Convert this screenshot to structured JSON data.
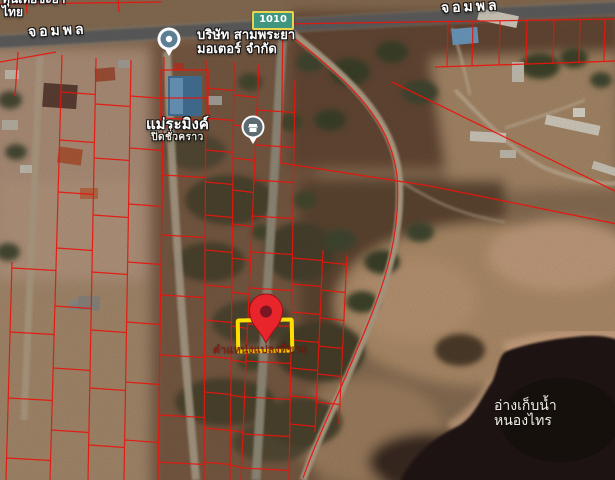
{
  "map": {
    "imagery": "satellite",
    "road_labels": {
      "left": "จอมพล",
      "right": "จอมพล"
    },
    "route_badge": {
      "number": "1010",
      "bg": "#3e9681",
      "border": "#e9d44e"
    },
    "pois": {
      "top_left_partial": {
        "line1": "ทุนเทียชะยา",
        "line2": "ไทย"
      },
      "motor_company": {
        "line1": "บริษัท สามพระยา",
        "line2": "มอเตอร์ จำกัด"
      },
      "closed_place": {
        "name": "แม่ระมิงค์",
        "status": "ปิดชั่วคราว"
      },
      "reservoir": {
        "line1": "อ่างเก็บน้ำ",
        "line2": "หนองไทร"
      }
    },
    "sale_plot": {
      "annotation": "ตำแหน่งแปลงที่ขาย",
      "annotation_color": "#7d1a10",
      "highlight_color": "#ffdf00",
      "pin_color": "#e8252b"
    },
    "overlay": {
      "parcel_line_color": "#e8150d"
    }
  }
}
